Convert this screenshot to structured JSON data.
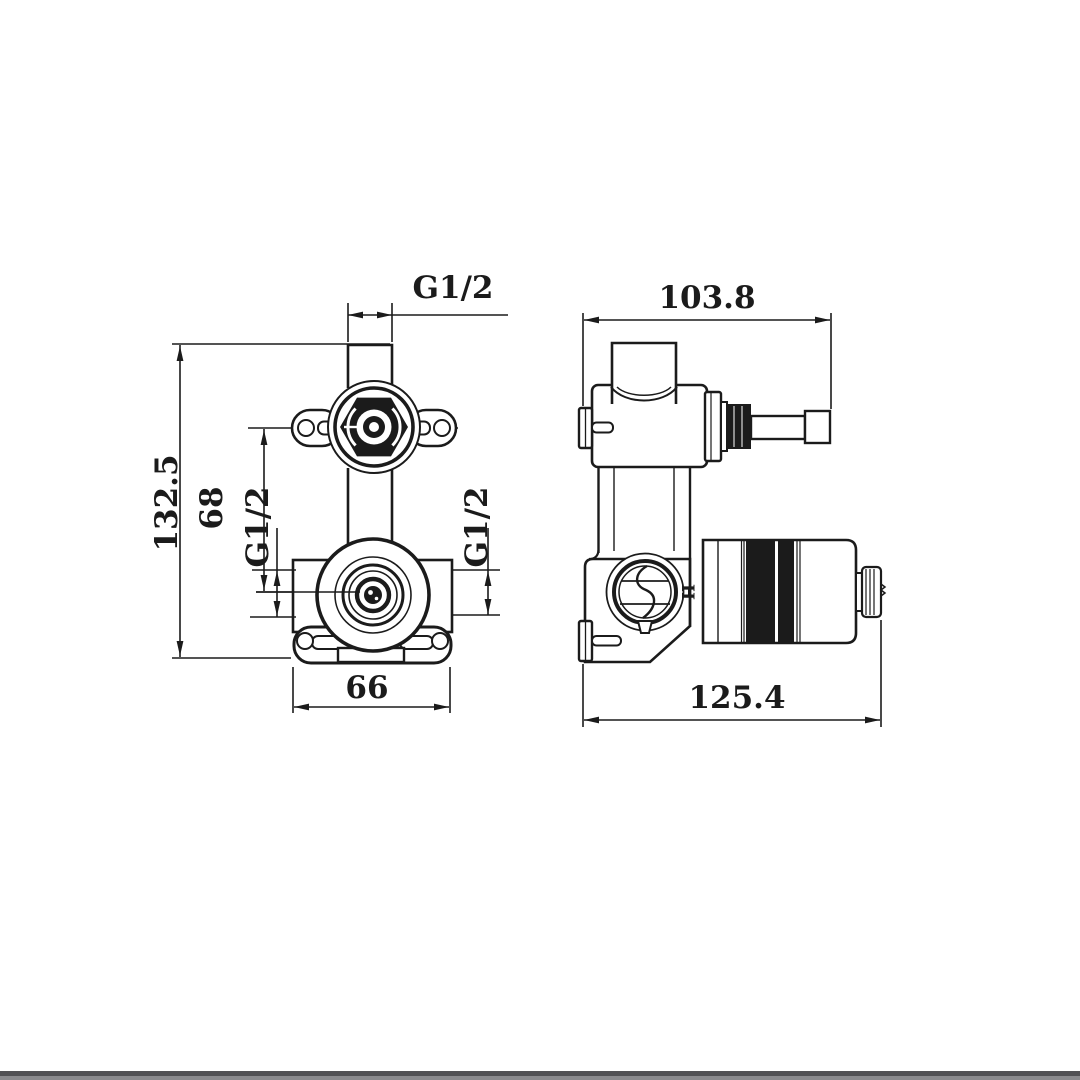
{
  "drawing": {
    "front_view": {
      "thread_top": "G1/2",
      "overall_height": "132.5",
      "port_spacing": "68",
      "thread_left": "G1/2",
      "thread_right": "G1/2",
      "base_width": "66"
    },
    "side_view": {
      "top_depth": "103.8",
      "overall_depth": "125.4",
      "hot_indicator": "H"
    },
    "colors": {
      "line": "#1b1b1b",
      "background": "#ffffff",
      "footer_dark": "#515154",
      "footer_light": "#8a8a8d"
    }
  }
}
